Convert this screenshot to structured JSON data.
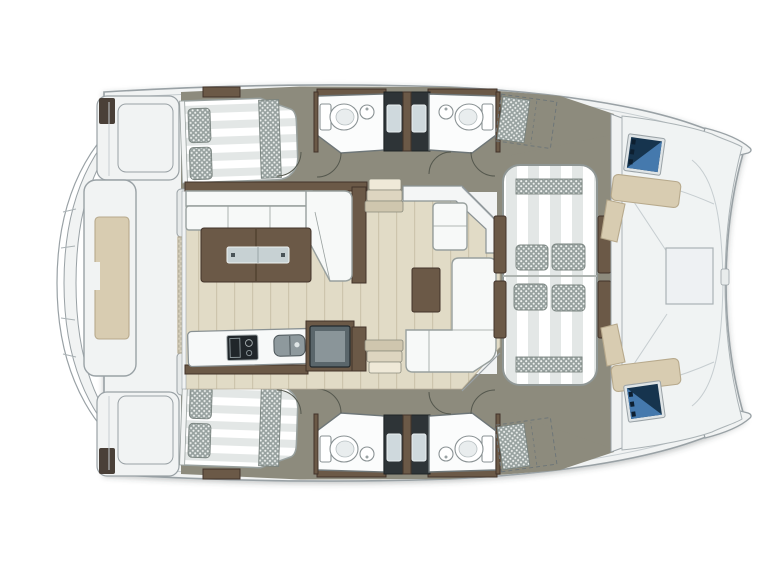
{
  "diagram": {
    "kind": "catamaran-yacht-deck-plan",
    "orientation": "bow-right",
    "areas": [
      {
        "id": "aft-crossbeam",
        "name": "stern crossbeam with steps"
      },
      {
        "id": "aft-platform-bench",
        "name": "aft central bench"
      },
      {
        "id": "swim-platform-port",
        "name": "port swim platform"
      },
      {
        "id": "swim-platform-stbd",
        "name": "starboard swim platform"
      },
      {
        "id": "aft-cockpit",
        "name": "aft cockpit deck"
      },
      {
        "id": "cabin-port-aft",
        "name": "port aft cabin double berth"
      },
      {
        "id": "cabin-stbd-aft",
        "name": "starboard aft cabin double berth"
      },
      {
        "id": "head-port-aft",
        "name": "port aft bathroom"
      },
      {
        "id": "head-port-fwd",
        "name": "port forward bathroom"
      },
      {
        "id": "head-stbd-aft",
        "name": "starboard aft bathroom"
      },
      {
        "id": "head-stbd-fwd",
        "name": "starboard forward bathroom"
      },
      {
        "id": "shower-port",
        "name": "port shower compartment"
      },
      {
        "id": "shower-stbd",
        "name": "starboard shower compartment"
      },
      {
        "id": "forepeak-port",
        "name": "port forepeak berth (dashed option)"
      },
      {
        "id": "forepeak-stbd",
        "name": "starboard forepeak berth (dashed option)"
      },
      {
        "id": "salon",
        "name": "salon"
      },
      {
        "id": "salon-sofa",
        "name": "L-shaped salon sofa"
      },
      {
        "id": "coffee-table",
        "name": "coffee table with glass insets"
      },
      {
        "id": "galley",
        "name": "galley with stove and sink"
      },
      {
        "id": "tv-unit",
        "name": "TV cabinet"
      },
      {
        "id": "dinette",
        "name": "forward dinette with L-sofa and table"
      },
      {
        "id": "stairs-port",
        "name": "companionway steps to port hull"
      },
      {
        "id": "stairs-stbd",
        "name": "companionway steps to starboard hull"
      },
      {
        "id": "forward-lounge",
        "name": "forward cockpit lounge sunbed"
      },
      {
        "id": "bow-deck",
        "name": "solid foredeck"
      },
      {
        "id": "bow-seat-port",
        "name": "port bow bench"
      },
      {
        "id": "bow-seat-stbd",
        "name": "starboard bow bench"
      },
      {
        "id": "bow-hatch-port",
        "name": "port bow hatch"
      },
      {
        "id": "bow-hatch-stbd",
        "name": "starboard bow hatch"
      }
    ]
  },
  "colors": {
    "deck": "#f1f3f3",
    "deckOutline": "#99a1a5",
    "corridor": "#8d8b7d",
    "floor": "#e1dbc6",
    "plankLine": "#cdc5ad",
    "floorEdge": "#b8b09a",
    "wood": "#6b5947",
    "woodDark": "#42332a",
    "sofa": "#f7f9f8",
    "sofaOutline": "#98a09e",
    "room": "#fbfcfc",
    "roomOutline": "#6e7678",
    "stripeLight": "#ffffff",
    "stripeGrey": "#e3e7e6",
    "checkBase": "#97a19f",
    "checkDot": "#eef1ef",
    "shower": "#2e3437",
    "windowGlass": "#cfd9dd",
    "hatchNavy": "#16344e",
    "hatchBlue": "#4579ad",
    "hatchFrame": "#dfe4e6",
    "tan": "#d8ccb1",
    "tanOutline": "#b7a98c",
    "screen": "#5a666b",
    "screenInner": "#8a9599",
    "glass": "#c7d1d3",
    "stoveTop": "#20262a",
    "sinkSteel": "#8e999d"
  }
}
